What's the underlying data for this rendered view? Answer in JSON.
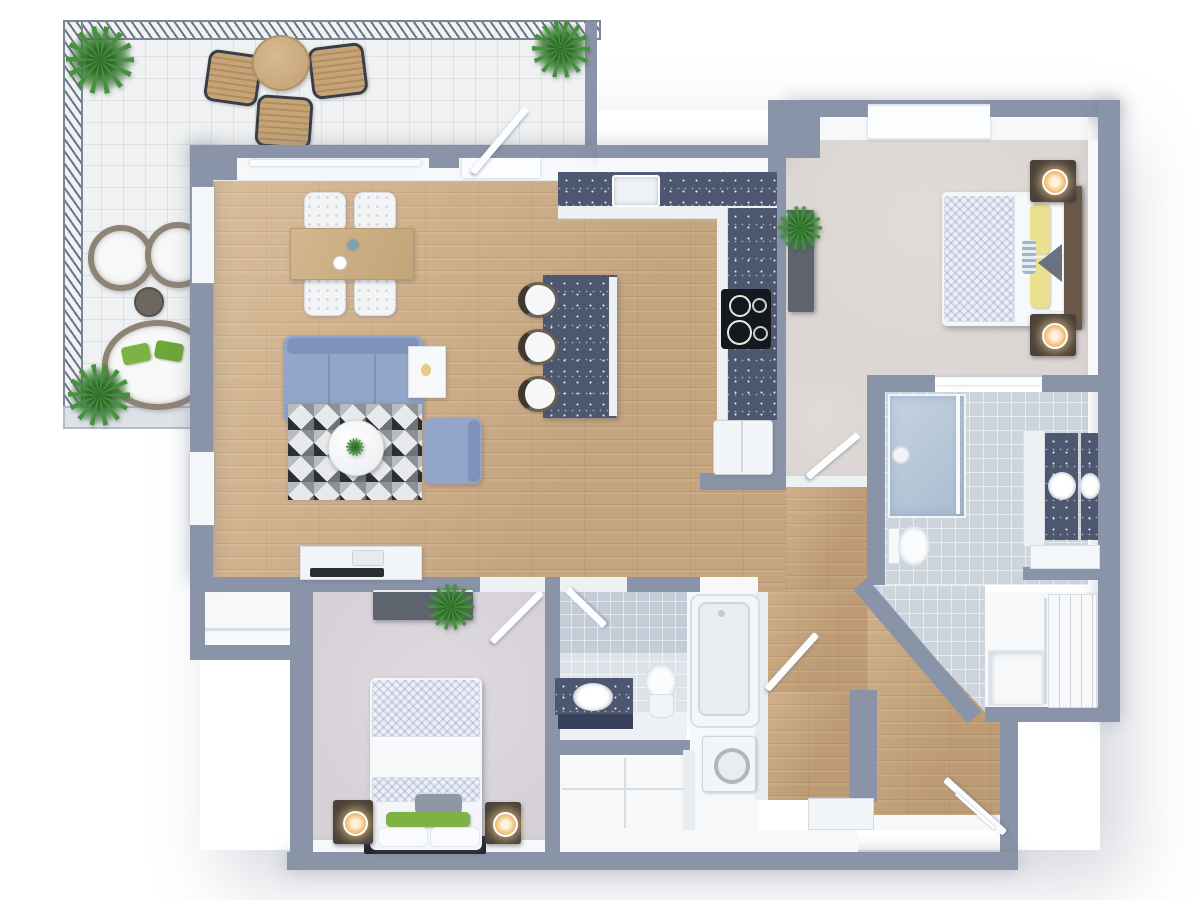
{
  "scene": {
    "kind": "3D rendered floor plan, top-down view",
    "width_px": 1200,
    "height_px": 900
  },
  "palette": {
    "wall": "#8a94a8",
    "wallFace": "#f6f8fa",
    "wood": "#d1af86",
    "woodHall": "#cba77d",
    "carpetMaster": "#dbd5d3",
    "carpetBedroom": "#d5d1d6",
    "balcony": "#eff1f2",
    "railing": "#6c7584",
    "tileMaster": "#ccd4dc",
    "tileBath": "#dde3e9",
    "tileWall": "#c3ccd7",
    "counter": "#4d5870",
    "cabinet": "#eef1f4",
    "sofa": "#93a5c9",
    "rugDark": "#2b2e33",
    "rugMid": "#8d9196",
    "tableWood": "#c9ab83",
    "furnDark": "#4a4138",
    "consoleGray": "#5d646e",
    "pillowYellow": "#e9e18f",
    "pillowGreen": "#7cb342",
    "duvet": "#edf0f6",
    "plant": "#46913d",
    "lamp": "#f0c27d",
    "appliance": "#f3f6f8",
    "stove": "#15181d"
  },
  "rooms": [
    {
      "id": "balcony",
      "name": "Balcony terrace"
    },
    {
      "id": "living-dining",
      "name": "Living and dining room"
    },
    {
      "id": "kitchen",
      "name": "Kitchen"
    },
    {
      "id": "master-bedroom",
      "name": "Bedroom 1"
    },
    {
      "id": "master-bathroom",
      "name": "Master bathroom"
    },
    {
      "id": "walk-in-closet",
      "name": "Walk-in closet"
    },
    {
      "id": "bedroom-2",
      "name": "Bedroom 2"
    },
    {
      "id": "bathroom-2",
      "name": "Bathroom 2"
    },
    {
      "id": "laundry",
      "name": "Laundry nook"
    },
    {
      "id": "storage",
      "name": "Storage closet"
    },
    {
      "id": "hall-closet",
      "name": "Hall closet"
    },
    {
      "id": "entry-hall",
      "name": "Entry hall"
    },
    {
      "id": "closet",
      "name": "Closet"
    }
  ],
  "furniture": {
    "balcony": [
      "round outdoor table",
      "3 outdoor chairs",
      "2 round wicker chairs",
      "round daybed with green cushions",
      "side table",
      "4 potted plants"
    ],
    "living_dining": [
      "wooden dining table",
      "4 white chairs",
      "blue 3-seat sofa",
      "blue armchair",
      "white side table",
      "geometric triangle rug",
      "round coffee table with plant",
      "tv console"
    ],
    "kitchen": [
      "l-shaped dark counter with sink",
      "cooktop",
      "refrigerator",
      "island with dark top",
      "3 bar stools"
    ],
    "master_bedroom": [
      "double bed with yellow pillows",
      "2 dark nightstands with lamps",
      "dark sideboard with plant"
    ],
    "master_bathroom": [
      "walk-in shower",
      "toilet",
      "double vanity with dark top"
    ],
    "walk_in_closet": [
      "wardrobe with sliding doors",
      "bench"
    ],
    "bedroom_2": [
      "double bed with green pillows",
      "2 dark nightstands with lamps",
      "dark dresser with plant"
    ],
    "bathroom_2": [
      "vanity with dark top",
      "toilet",
      "bathtub"
    ],
    "laundry": [
      "washing machine"
    ]
  }
}
